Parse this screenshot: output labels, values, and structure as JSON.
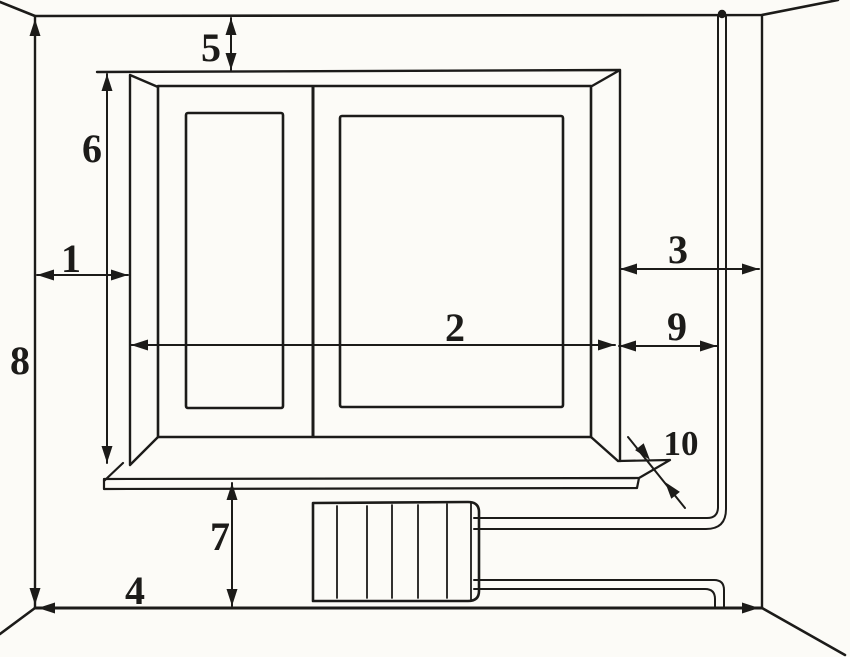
{
  "diagram": {
    "kind": "hand-drawn window measurement scheme",
    "colors": {
      "ink": "#1c1b19",
      "paper": "#fcfbf7"
    },
    "parts": [
      "room-walls",
      "window-opening",
      "window-frame",
      "left-casement-glass",
      "right-casement-glass",
      "windowsill",
      "radiator",
      "heating-riser-pipe",
      "radiator-supply-pipe",
      "radiator-return-pipe"
    ],
    "dimensions": [
      {
        "label": "1"
      },
      {
        "label": "2"
      },
      {
        "label": "3"
      },
      {
        "label": "4"
      },
      {
        "label": "5"
      },
      {
        "label": "6"
      },
      {
        "label": "7"
      },
      {
        "label": "8"
      },
      {
        "label": "9"
      },
      {
        "label": "10"
      }
    ]
  }
}
